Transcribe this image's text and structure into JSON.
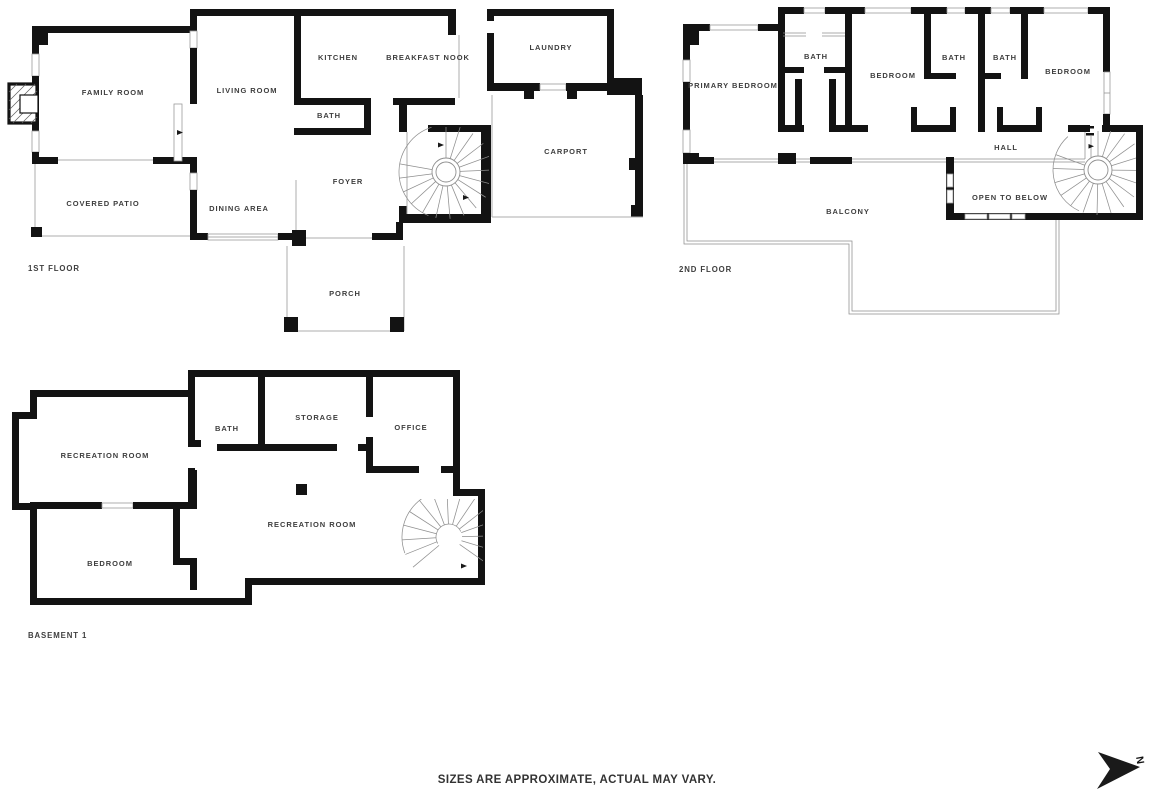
{
  "floors": [
    {
      "title": "1ST FLOOR",
      "rooms": [
        {
          "key": "family-room",
          "label": "FAMILY ROOM"
        },
        {
          "key": "living-room",
          "label": "LIVING ROOM"
        },
        {
          "key": "kitchen",
          "label": "KITCHEN"
        },
        {
          "key": "breakfast-nook",
          "label": "BREAKFAST NOOK"
        },
        {
          "key": "laundry",
          "label": "LAUNDRY"
        },
        {
          "key": "bath",
          "label": "BATH"
        },
        {
          "key": "carport",
          "label": "CARPORT"
        },
        {
          "key": "covered-patio",
          "label": "COVERED PATIO"
        },
        {
          "key": "dining-area",
          "label": "DINING AREA"
        },
        {
          "key": "foyer",
          "label": "FOYER"
        },
        {
          "key": "porch",
          "label": "PORCH"
        }
      ]
    },
    {
      "title": "2ND FLOOR",
      "rooms": [
        {
          "key": "primary-bedroom",
          "label": "PRIMARY BEDROOM"
        },
        {
          "key": "primary-bath",
          "label": "BATH"
        },
        {
          "key": "bedroom-middle",
          "label": "BEDROOM"
        },
        {
          "key": "bath-left",
          "label": "BATH"
        },
        {
          "key": "bath-right",
          "label": "BATH"
        },
        {
          "key": "bedroom-right",
          "label": "BEDROOM"
        },
        {
          "key": "hall",
          "label": "HALL"
        },
        {
          "key": "open-to-below",
          "label": "OPEN TO BELOW"
        },
        {
          "key": "balcony",
          "label": "BALCONY"
        }
      ]
    },
    {
      "title": "BASEMENT 1",
      "rooms": [
        {
          "key": "recreation-room-upper",
          "label": "RECREATION ROOM"
        },
        {
          "key": "bath",
          "label": "BATH"
        },
        {
          "key": "storage",
          "label": "STORAGE"
        },
        {
          "key": "office",
          "label": "OFFICE"
        },
        {
          "key": "recreation-room-main",
          "label": "RECREATION ROOM"
        },
        {
          "key": "bedroom",
          "label": "BEDROOM"
        }
      ]
    }
  ],
  "footer": {
    "disclaimer": "SIZES ARE APPROXIMATE, ACTUAL MAY VARY."
  },
  "compass": {
    "north_label": "N"
  },
  "colors": {
    "wall": "#131313",
    "thin_line": "#aeaeae",
    "label_text": "#3e3e3e",
    "background": "#ffffff"
  }
}
